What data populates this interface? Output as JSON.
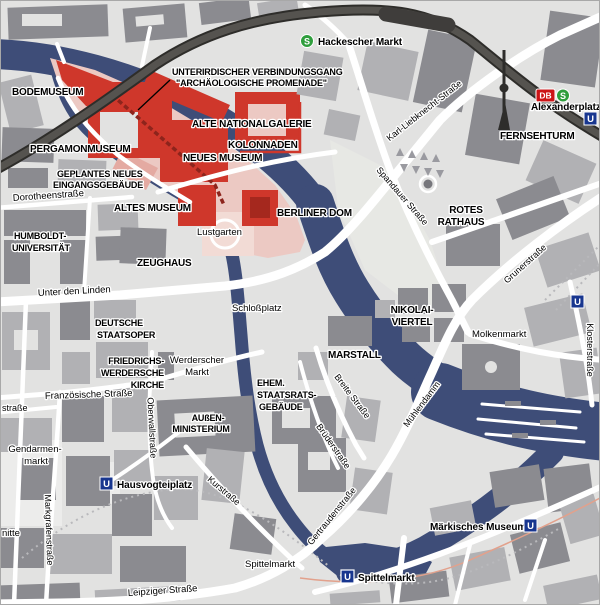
{
  "map_type": "city-map-berlin-museumsinsel",
  "colors": {
    "water": "#3e4d78",
    "land": "#e2e2e1",
    "building_dark": "#8b8b90",
    "building_medium": "#b1b1b4",
    "museum_area_pink": "#ecc9c3",
    "museum_building_red": "#cf372b",
    "museum_detail_dark_red": "#a5281e",
    "railway_dark": "#44423f",
    "road_white": "#ffffff",
    "sbahn_green": "#2f9e3d",
    "ubahn_blue": "#18368f",
    "db_red": "#cc1417",
    "label_black": "#000000"
  },
  "island": {
    "bodemuseum": "BODEMUSEUM",
    "pergamonmuseum": "PERGAMONMUSEUM",
    "geplantes1": "GEPLANTES NEUES",
    "geplantes2": "EINGANGSGEBÄUDE",
    "altes_museum": "ALTES MUSEUM",
    "neues_museum": "NEUES MUSEUM",
    "alte_nationalgalerie": "ALTE NATIONALGALERIE",
    "kolonnaden": "KOLONNADEN",
    "passage1": "UNTERIRDISCHER VERBINDUNGSGANG",
    "passage2": "\"ARCHÄOLOGISCHE PROMENADE\"",
    "berliner_dom": "BERLINER DOM",
    "lustgarten": "Lustgarten"
  },
  "places": {
    "zeughaus": "ZEUGHAUS",
    "humboldt1": "HUMBOLDT-",
    "humboldt2": "UNIVERSITÄT",
    "staatsoper1": "DEUTSCHE",
    "staatsoper2": "STAATSOPER",
    "kirche1": "FRIEDRICHS-",
    "kirche2": "WERDERSCHE",
    "kirche3": "KIRCHE",
    "aussenmin1": "AUßEN-",
    "aussenmin2": "MINISTERIUM",
    "staatsrat1": "EHEM.",
    "staatsrat2": "STAATSRATS-",
    "staatsrat3": "GEBÄUDE",
    "rotes_rathaus1": "ROTES",
    "rotes_rathaus2": "RATHAUS",
    "nikolai1": "NIKOLAI-",
    "nikolai2": "VIERTEL",
    "marstall": "MARSTALL",
    "fernsehturm": "FERNSEHTURM",
    "gendarmenmarkt1": "Gendarmen-",
    "gendarmenmarkt2": "markt",
    "schlossplatz": "Schloßplatz",
    "werderscher1": "Werderscher",
    "werderscher2": "Markt",
    "molkenmarkt": "Molkenmarkt",
    "spittelmarkt": "Spittelmarkt"
  },
  "streets": {
    "unter_den_linden": "Unter den Linden",
    "dorotheenstrasse": "Dorotheenstraße",
    "franzoesische": "Französische Straße",
    "leipziger": "Leipziger Straße",
    "karl_liebknecht": "Karl-Liebknecht-Straße",
    "spandauer": "Spandauer Straße",
    "grunerstrasse": "Grunerstraße",
    "klosterstrasse": "Klosterstraße",
    "muehlendamm": "Mühlendamm",
    "breite": "Breite Straße",
    "brueder": "Brüderstraße",
    "gertrauden": "Gertraudenstraße",
    "oberwall": "Oberwallstraße",
    "kurstrasse": "Kurstraße",
    "markgrafen": "Markgrafenstraße",
    "partial_strasse": "straße",
    "partial_nitte": "nitte"
  },
  "stations": {
    "hackescher_markt": "Hackescher Markt",
    "alexanderplatz": "Alexanderplatz",
    "hausvogteiplatz": "Hausvogteiplatz",
    "spittelmarkt": "Spittelmarkt",
    "maerkisches_museum": "Märkisches Museum"
  },
  "logos": {
    "s": "S",
    "u": "U",
    "db": "DB"
  }
}
